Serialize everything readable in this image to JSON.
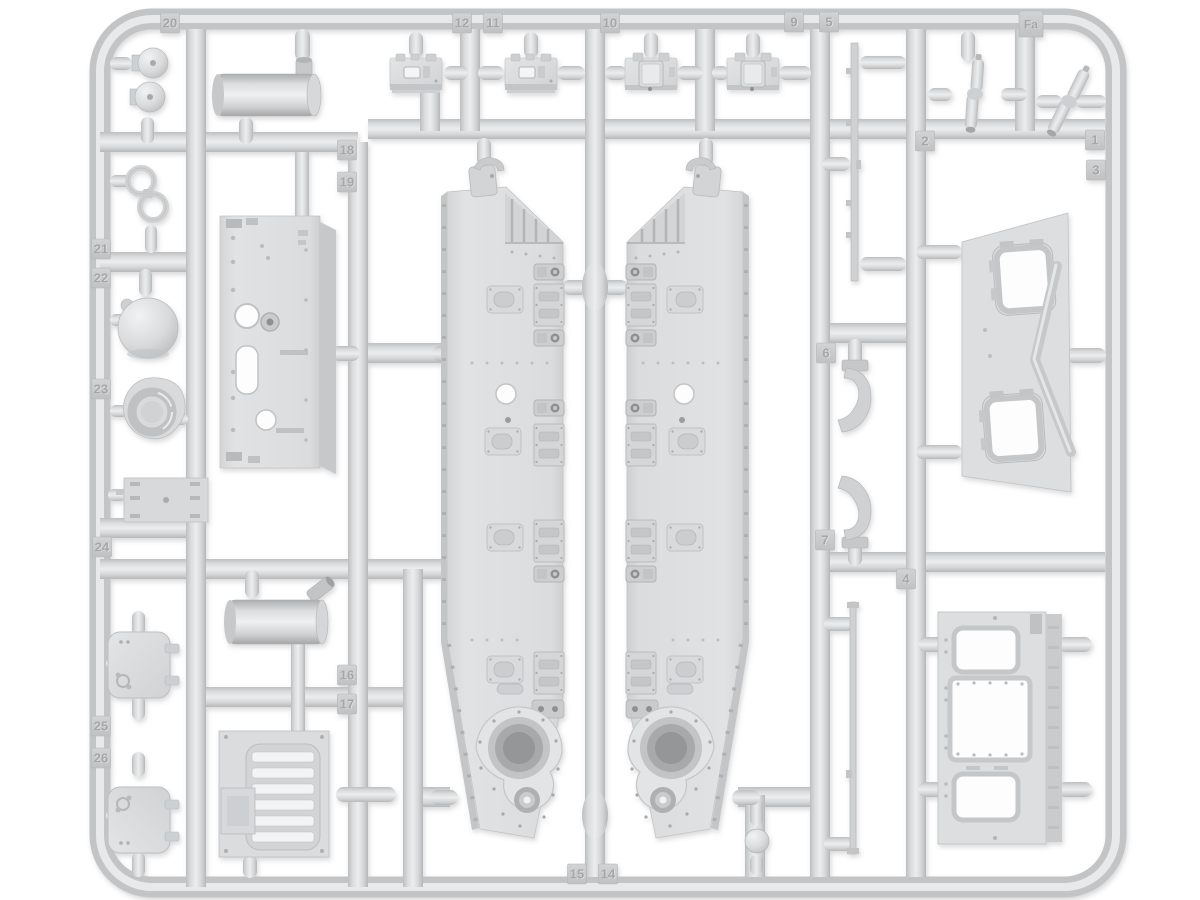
{
  "image_type": "product-photo-of-plastic-model-kit-sprue",
  "background_color": "#ffffff",
  "sprue": {
    "letter_tag": {
      "label": "Fa",
      "x": 1031,
      "y": 24
    },
    "plastic_color": "#d7d9db",
    "tag_face_color": "#c9cbcd",
    "tag_text_color": "#a4a6a8",
    "part_number_tags": [
      {
        "label": "20",
        "x": 170,
        "y": 23
      },
      {
        "label": "12",
        "x": 462,
        "y": 23
      },
      {
        "label": "11",
        "x": 493,
        "y": 23
      },
      {
        "label": "10",
        "x": 610,
        "y": 23
      },
      {
        "label": "9",
        "x": 794,
        "y": 22
      },
      {
        "label": "5",
        "x": 829,
        "y": 22
      },
      {
        "label": "2",
        "x": 925,
        "y": 141
      },
      {
        "label": "1",
        "x": 1095,
        "y": 140
      },
      {
        "label": "3",
        "x": 1096,
        "y": 170
      },
      {
        "label": "18",
        "x": 347,
        "y": 150
      },
      {
        "label": "19",
        "x": 347,
        "y": 182
      },
      {
        "label": "21",
        "x": 101,
        "y": 249
      },
      {
        "label": "22",
        "x": 101,
        "y": 278
      },
      {
        "label": "23",
        "x": 101,
        "y": 389
      },
      {
        "label": "6",
        "x": 826,
        "y": 353
      },
      {
        "label": "7",
        "x": 825,
        "y": 540
      },
      {
        "label": "24",
        "x": 102,
        "y": 547
      },
      {
        "label": "4",
        "x": 906,
        "y": 579
      },
      {
        "label": "16",
        "x": 347,
        "y": 675
      },
      {
        "label": "17",
        "x": 347,
        "y": 704
      },
      {
        "label": "25",
        "x": 101,
        "y": 726
      },
      {
        "label": "26",
        "x": 101,
        "y": 758
      },
      {
        "label": "15",
        "x": 577,
        "y": 874
      },
      {
        "label": "14",
        "x": 608,
        "y": 874
      }
    ]
  }
}
